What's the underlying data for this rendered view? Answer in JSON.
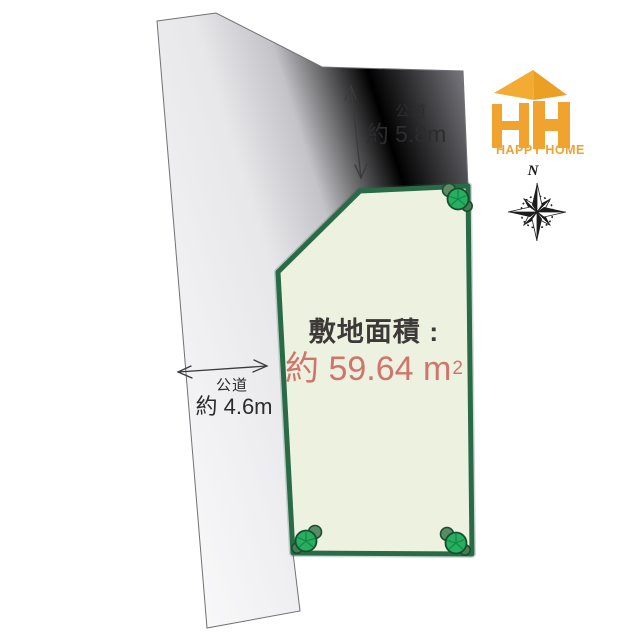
{
  "diagram": {
    "site": {
      "area_label": "敷地面積 :",
      "area_value": "約 59.64 m",
      "area_unit_sup": "2",
      "fill_color": "#edf2e0",
      "border_color": "#2a6b47",
      "area_value_color": "#d0756c"
    },
    "road_top": {
      "type_label": "公道",
      "width_label": "約 5.8m"
    },
    "road_left": {
      "type_label": "公道",
      "width_label": "約 4.6m"
    },
    "colors": {
      "road_light": "#f8f8f9",
      "road_dark": "#76767c",
      "dimension_line": "#3a3a3c",
      "tree_green": "#27ae5e",
      "tree_dark_green": "#15502e"
    }
  },
  "branding": {
    "logo_text": "HAPPY HOME",
    "logo_color": "#f0a32f"
  },
  "compass": {
    "north_label": "N"
  }
}
